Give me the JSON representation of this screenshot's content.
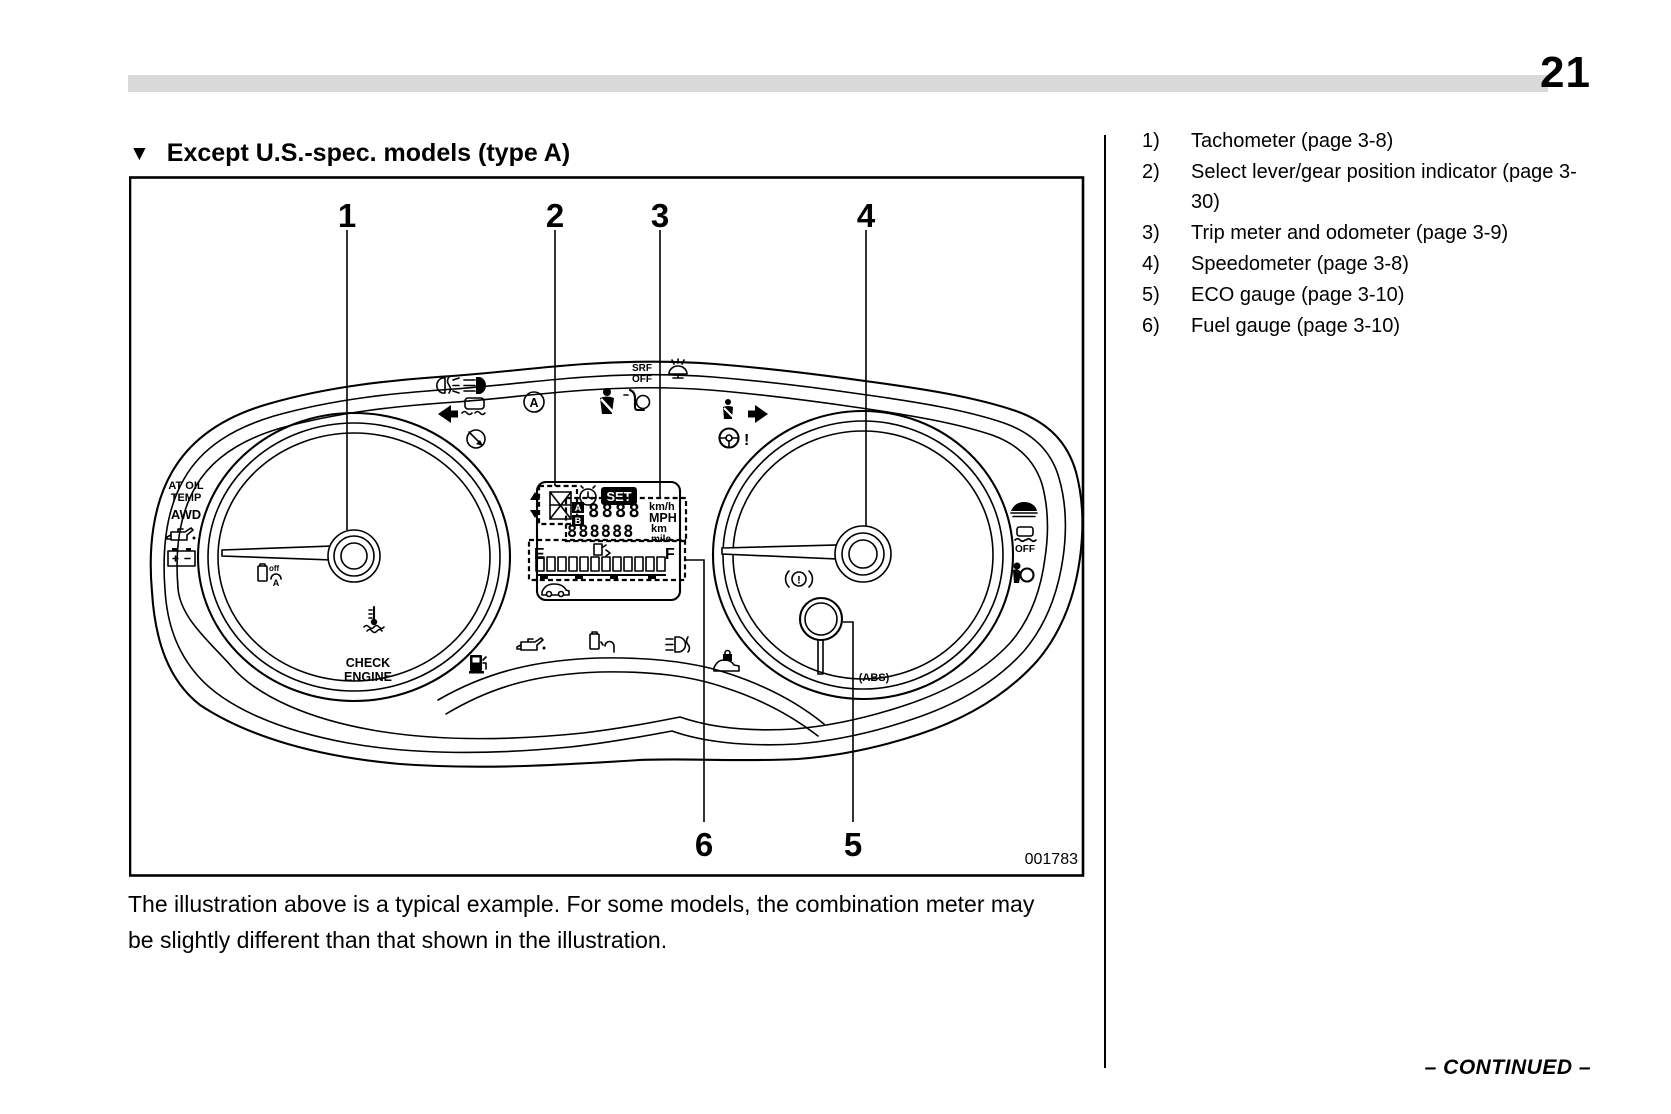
{
  "page": {
    "number": "21",
    "continued": "– CONTINUED –"
  },
  "heading": {
    "marker": "▼",
    "text": "Except U.S.-spec. models (type A)"
  },
  "legend": {
    "items": [
      {
        "num": "1)",
        "label": "Tachometer (page 3-8)"
      },
      {
        "num": "2)",
        "label": "Select lever/gear position indicator (page 3-30)"
      },
      {
        "num": "3)",
        "label": "Trip meter and odometer (page 3-9)"
      },
      {
        "num": "4)",
        "label": "Speedometer (page 3-8)"
      },
      {
        "num": "5)",
        "label": "ECO gauge (page 3-10)"
      },
      {
        "num": "6)",
        "label": "Fuel gauge (page 3-10)"
      }
    ]
  },
  "figure": {
    "code": "001783",
    "callouts": {
      "n1": "1",
      "n2": "2",
      "n3": "3",
      "n4": "4",
      "n5": "5",
      "n6": "6"
    },
    "lcd": {
      "set": "SET",
      "trip_a": "A",
      "trip_b": "B",
      "trip_digits": "8888",
      "odo_digits": "888888",
      "kmh": "km/h",
      "mph": "MPH",
      "km": "km",
      "mile": "mile",
      "empty": "E",
      "full": "F"
    },
    "labels": {
      "at_oil_1": "AT OIL",
      "at_oil_2": "TEMP",
      "awd": "AWD",
      "check_1": "CHECK",
      "check_2": "ENGINE",
      "srf_1": "SRF",
      "srf_2": "OFF",
      "vdc_off": "OFF",
      "abs": "(ABS)",
      "brake_excl": "!",
      "steer_excl": "!",
      "a_indicator": "A",
      "idle_off": "off",
      "idle_a": "A"
    }
  },
  "caption": {
    "line1": "The illustration above is a typical example. For some models, the combination meter may",
    "line2": "be slightly different than that shown in the illustration."
  }
}
